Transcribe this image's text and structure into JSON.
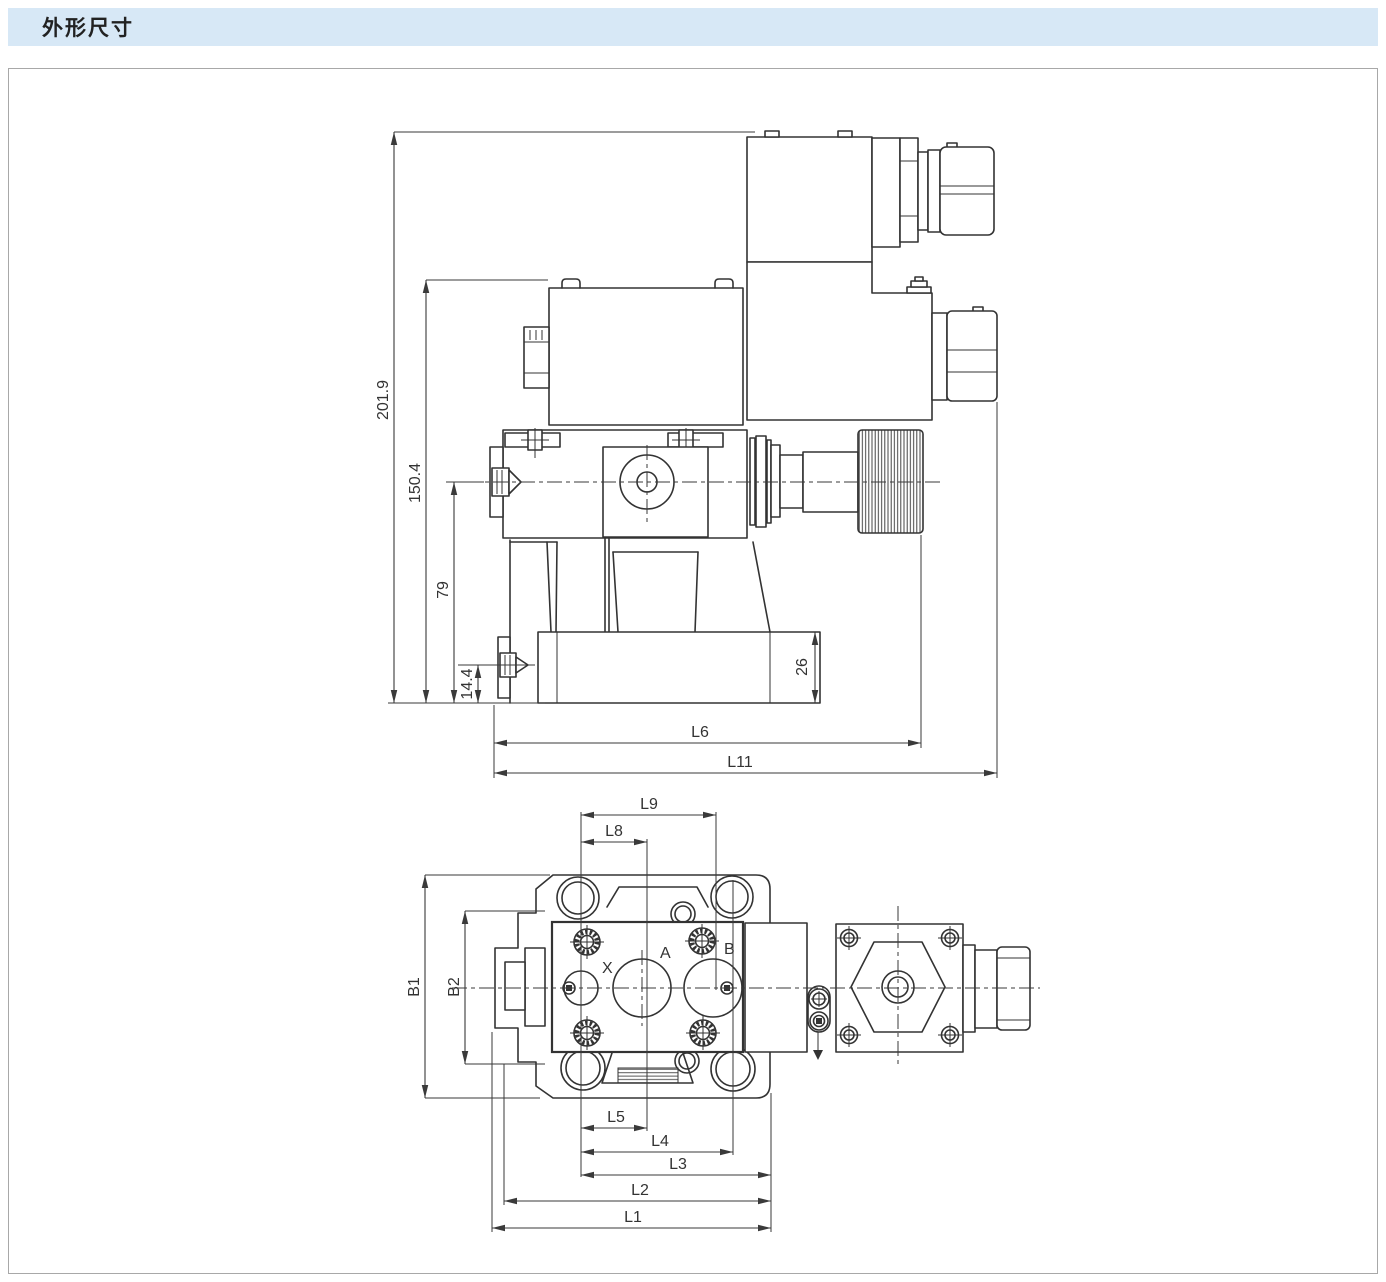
{
  "header": {
    "title": "外形尺寸"
  },
  "colors": {
    "header_bg": "#d7e8f6",
    "line": "#333333",
    "panel_border": "#a8a8a8"
  },
  "side_view": {
    "dim_total_height": "201.9",
    "dim_upper_height": "150.4",
    "dim_pilot_height": "79",
    "dim_port_height": "14.4",
    "dim_base_thickness": "26",
    "dim_length_l6": "L6",
    "dim_length_l11": "L11"
  },
  "top_view": {
    "dim_l9": "L9",
    "dim_l8": "L8",
    "dim_l5": "L5",
    "dim_l4": "L4",
    "dim_l3": "L3",
    "dim_l2": "L2",
    "dim_l1": "L1",
    "dim_b1": "B1",
    "dim_b2": "B2",
    "port_x": "X",
    "port_a": "A",
    "port_b": "B"
  }
}
